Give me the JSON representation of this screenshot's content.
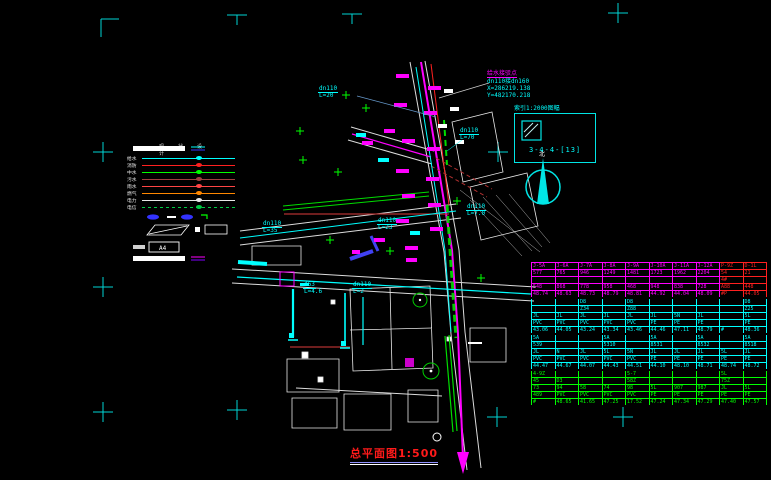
{
  "title": {
    "text": "总平面图1:500"
  },
  "north": {
    "label": "北"
  },
  "index_box": {
    "label": "索引1:2000图幅",
    "code": "3-4-4-[13]"
  },
  "annotation": {
    "line1": "给水接驳点",
    "line2": "dn110接dn160",
    "line3": "X=286219.138",
    "line4": "Y=482170.218"
  },
  "legend": {
    "col1": "现状",
    "col2": "设计",
    "items": [
      {
        "label": "给水",
        "color": "#00ffff",
        "dash": false
      },
      {
        "label": "消防",
        "color": "#ff2020",
        "dash": false
      },
      {
        "label": "中水",
        "color": "#00ff00",
        "dash": false
      },
      {
        "label": "污水",
        "color": "#a04040",
        "dash": false
      },
      {
        "label": "雨水",
        "color": "#ff4545",
        "dash": false
      },
      {
        "label": "燃气",
        "color": "#ff8800",
        "dash": false
      },
      {
        "label": "电力",
        "color": "#e8e8e8",
        "dash": false
      },
      {
        "label": "电信",
        "color": "#00cc44",
        "dash": true
      }
    ]
  },
  "pipe_labels": [
    {
      "x": 318,
      "y": 86,
      "l1": "dn110",
      "l2": "L=20"
    },
    {
      "x": 459,
      "y": 128,
      "l1": "dn110",
      "l2": "L=70"
    },
    {
      "x": 262,
      "y": 221,
      "l1": "dn110",
      "l2": "L=35"
    },
    {
      "x": 377,
      "y": 218,
      "l1": "dn110",
      "l2": "L=23"
    },
    {
      "x": 466,
      "y": 204,
      "l1": "dn110",
      "l2": "L=7.0"
    },
    {
      "x": 303,
      "y": 282,
      "l1": "d63",
      "l2": "L=4.6"
    },
    {
      "x": 352,
      "y": 282,
      "l1": "dn110",
      "l2": "L=2"
    }
  ],
  "table": {
    "alert_color": "#ff2020",
    "sections": [
      {
        "color": "#ff00ff",
        "red_cols": [
          8,
          9
        ],
        "rows": [
          [
            "J-5A",
            "J-6A",
            "J-7A",
            "J-8A",
            "J-9A",
            "J-10A",
            "J-11A",
            "J-12A",
            "P-9Z",
            "D-1L"
          ],
          [
            "577",
            "765",
            "946",
            "1249",
            "1481",
            "1723",
            "1962",
            "2204",
            "54",
            "21"
          ],
          [
            "",
            "",
            "",
            "",
            "",
            "",
            "",
            "",
            "4#",
            ""
          ],
          [
            "548",
            "868",
            "778",
            "958",
            "468",
            "948",
            "838",
            "728",
            "A88",
            "448"
          ],
          [
            "48.74",
            "48.63",
            "48.73",
            "48.79",
            "48.81",
            "44.92",
            "44.04",
            "48.09",
            "#P",
            "44.05"
          ]
        ]
      },
      {
        "color": "#00ffff",
        "red_cols": [],
        "rows": [
          [
            "",
            "",
            "D8",
            "",
            "D8",
            "",
            "",
            "",
            "",
            "D8"
          ],
          [
            "",
            "",
            "Z34",
            "",
            "Z88",
            "",
            "",
            "",
            "",
            "Z25"
          ],
          [
            "JL",
            "JL",
            "JL",
            "JL",
            "JL",
            "JL",
            "5N",
            "JL",
            "",
            "5L"
          ],
          [
            "PVC",
            "PVC",
            "PVC",
            "PVC",
            "PVC",
            "PE",
            "PE",
            "PE",
            "",
            "PE"
          ],
          [
            "43.06",
            "44.05",
            "43.24",
            "43.34",
            "43.46",
            "44.46",
            "47.11",
            "48.79",
            "#",
            "48.36"
          ]
        ]
      },
      {
        "color": "#00ffff",
        "red_cols": [],
        "rows": [
          [
            "5A",
            "",
            "",
            "5A",
            "",
            "5A",
            "",
            "5A",
            "",
            "5A"
          ],
          [
            "539",
            "",
            "",
            "5310",
            "",
            "8531",
            "",
            "8532",
            "",
            "8518"
          ],
          [
            "JL",
            "N",
            "JL",
            "5L",
            "5N",
            "JL",
            "JL",
            "JL",
            "5L",
            "JL"
          ],
          [
            "PVC",
            "PVC",
            "PVC",
            "PVC",
            "PVC",
            "PE",
            "PE",
            "PE",
            "PE",
            "PE"
          ],
          [
            "44.47",
            "44.67",
            "44.07",
            "44.43",
            "44.51",
            "44.10",
            "48.10",
            "48.71",
            "48.74",
            "48.72"
          ]
        ]
      },
      {
        "color": "#00ff00",
        "red_cols": [],
        "rows": [
          [
            "4-9Z",
            "",
            "",
            "",
            "5-7",
            "",
            "",
            "",
            "5L",
            ""
          ],
          [
            "45",
            "D3",
            "",
            "",
            "58Z",
            "",
            "",
            "",
            "75Z",
            ""
          ],
          [
            "73",
            "94",
            "58",
            "74",
            "98",
            "5L",
            "907",
            "987",
            "JL",
            "5L"
          ],
          [
            "489",
            "PVC",
            "PVC",
            "PVC",
            "PVC",
            "PE",
            "PE",
            "PE",
            "PE",
            "PE"
          ],
          [
            "#",
            "48.65",
            "41.65",
            "47.25",
            "17.52",
            "47.24",
            "47.34",
            "47.29",
            "47.40",
            "47.57"
          ]
        ]
      }
    ]
  }
}
